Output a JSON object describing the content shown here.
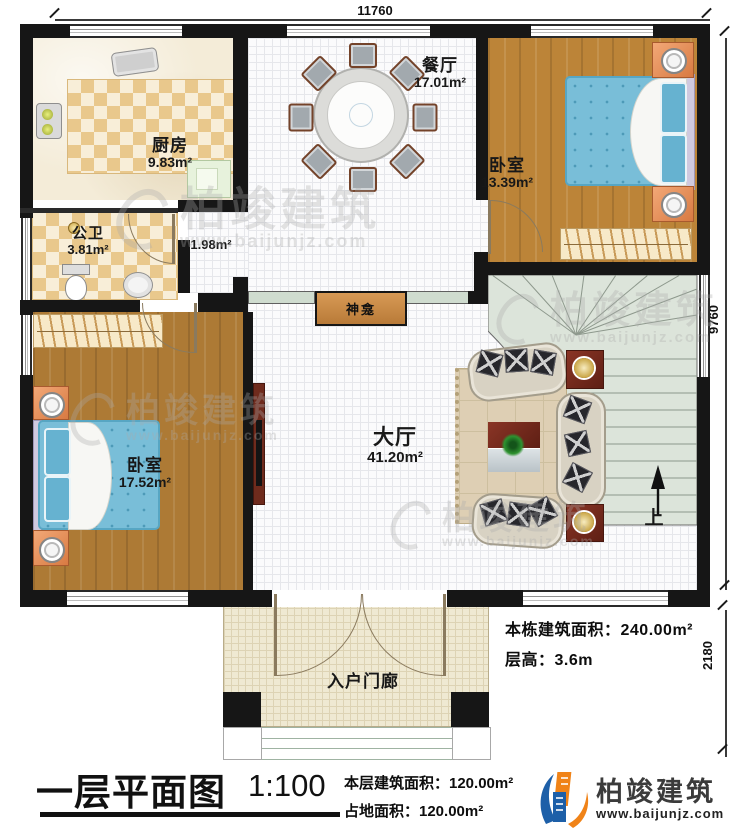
{
  "title_block": {
    "title": "一层平面图",
    "scale": "1:100",
    "floor_area_label": "本层建筑面积：120.00m²",
    "ground_area_label": "占地面积：120.00m²"
  },
  "side_notes": {
    "building_area": "本栋建筑面积：240.00m²",
    "floor_height": "层高：3.6m"
  },
  "dimensions": {
    "top": "11760",
    "right_upper": "9760",
    "right_lower": "2180"
  },
  "rooms": {
    "kitchen": {
      "name": "厨房",
      "area": "9.83m²"
    },
    "bathroom": {
      "name": "公卫",
      "area": "3.81m²"
    },
    "hallway": {
      "area": "1.98m²"
    },
    "dining": {
      "name": "餐厅",
      "area": "17.01m²"
    },
    "bedroom_right": {
      "name": "卧室",
      "area": "13.39m²"
    },
    "bedroom_left": {
      "name": "卧室",
      "area": "17.52m²"
    },
    "living": {
      "name": "大厅",
      "area": "41.20m²"
    },
    "shrine": {
      "name": "神龛"
    },
    "porch": {
      "name": "入户门廊"
    },
    "stairs": {
      "direction": "上"
    }
  },
  "brand": {
    "company": "柏竣建筑",
    "website": "www.baijunjz.com"
  },
  "watermark": {
    "company": "柏竣建筑",
    "website": "www.baijunjz.com"
  },
  "colors": {
    "wall": "#161616",
    "wood_floor": "#ad7a35",
    "mattress_blue": "#79bed8",
    "stair_sage": "#dce4da",
    "table_maroon": "#7e2c22",
    "brand_blue": "#1d5fa8",
    "brand_orange": "#f08318"
  }
}
